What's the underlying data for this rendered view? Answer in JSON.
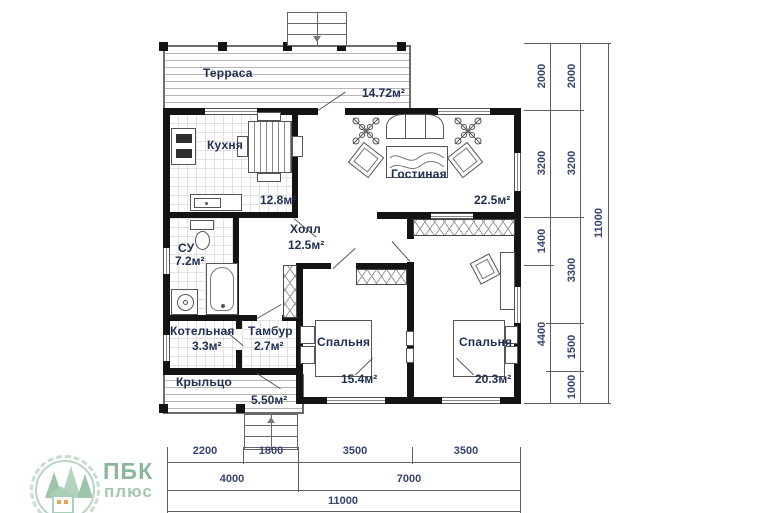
{
  "plan": {
    "rooms": {
      "terrace": {
        "name": "Терраса",
        "area": "14.72м²"
      },
      "kitchen": {
        "name": "Кухня",
        "area": "12.8м²"
      },
      "living": {
        "name": "Гостиная",
        "area": "22.5м²"
      },
      "hall": {
        "name": "Холл",
        "area": "12.5м²"
      },
      "bathroom": {
        "name": "СУ",
        "area": "7.2м²"
      },
      "boiler": {
        "name": "Котельная",
        "area": "3.3м²"
      },
      "tambour": {
        "name": "Тамбур",
        "area": "2.7м²"
      },
      "bedroom1": {
        "name": "Спальня",
        "area": "15.4м²"
      },
      "bedroom2": {
        "name": "Спальня",
        "area": "20.3м²"
      },
      "porch": {
        "name": "Крыльцо",
        "area": "5.50м²"
      }
    },
    "dims_right": {
      "inner": [
        "2000",
        "3200",
        "1400",
        "4400"
      ],
      "middle": [
        "2000",
        "3200",
        "3300",
        "1500",
        "1000"
      ],
      "outer": [
        "11000"
      ]
    },
    "dims_bottom": {
      "top": [
        "2200",
        "1800",
        "3500",
        "3500"
      ],
      "middle": [
        "4000",
        "7000"
      ],
      "bottom": [
        "11000"
      ]
    }
  },
  "logo": {
    "line1": "ПБК",
    "line2": "плюс"
  },
  "colors": {
    "wall": "#141414",
    "label": "#1f2e52",
    "dimension": "#36436d",
    "logo_green": "#8bb79a",
    "logo_light_green": "#b9d6c4",
    "logo_ground": "#e5bd85"
  }
}
